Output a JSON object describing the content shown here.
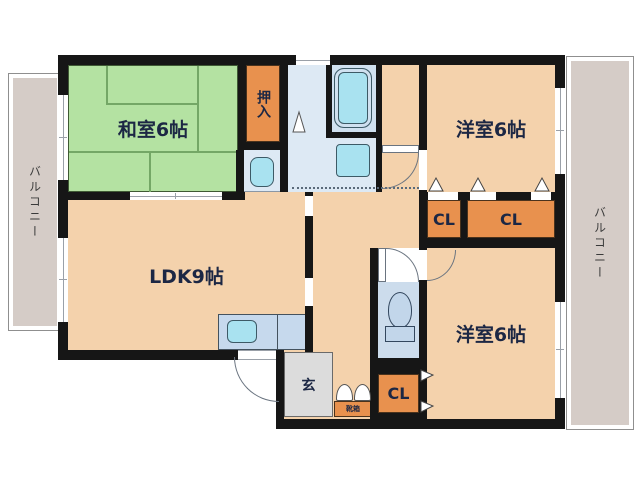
{
  "floorplan": {
    "rooms": {
      "washitsu": {
        "label": "和室6帖"
      },
      "oshiire": {
        "label": "押入"
      },
      "yoshitsu_tr": {
        "label": "洋室6帖"
      },
      "yoshitsu_br": {
        "label": "洋室6帖"
      },
      "ldk": {
        "label": "LDK9帖"
      },
      "cl1": {
        "label": "CL"
      },
      "cl2": {
        "label": "CL"
      },
      "cl3": {
        "label": "CL"
      },
      "genkan": {
        "label": "玄"
      },
      "shoebox": {
        "label": "靴箱"
      },
      "balcony_left": {
        "label": "バルコニー"
      },
      "balcony_right": {
        "label": "バルコニー"
      }
    },
    "colors": {
      "wall": "#161616",
      "room_peach": "#f4d2ac",
      "tatami_green": "#b4e2a2",
      "tatami_line": "#74a766",
      "closet_orange": "#e8914e",
      "balcony_gray": "#d5ccc7",
      "genkan_gray": "#dcdcdc",
      "washroom_blue": "#dde9f4",
      "bathroom_blue": "#d0e1f0",
      "fixture_cyan": "#a9e2f0",
      "counter_blue": "#c6d9ed",
      "toilet_blue": "#ccdcec",
      "text_navy": "#1c2744"
    }
  }
}
